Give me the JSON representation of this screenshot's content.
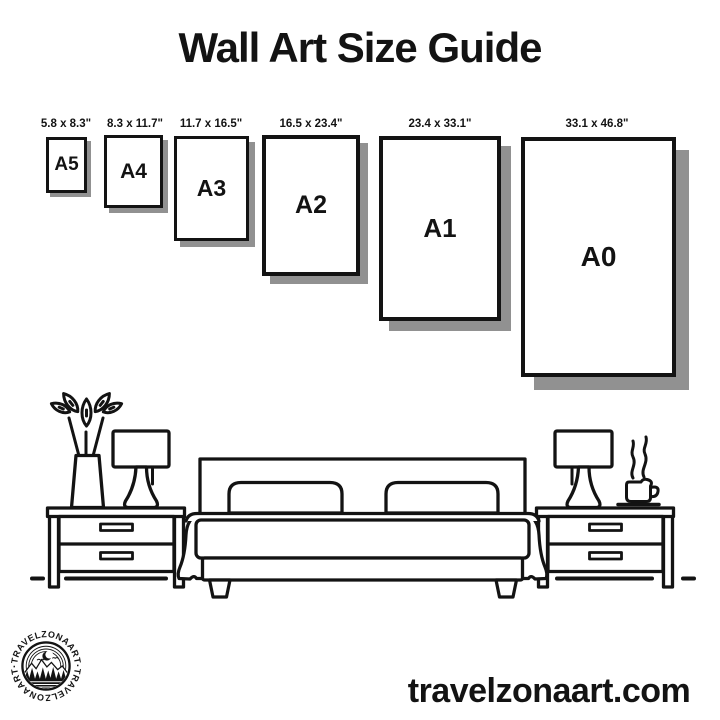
{
  "title": "Wall Art Size Guide",
  "frames": [
    {
      "label": "A5",
      "size": "5.8 x 8.3\""
    },
    {
      "label": "A4",
      "size": "8.3 x 11.7\""
    },
    {
      "label": "A3",
      "size": "11.7 x 16.5\""
    },
    {
      "label": "A2",
      "size": "16.5 x 23.4\""
    },
    {
      "label": "A1",
      "size": "23.4 x 33.1\""
    },
    {
      "label": "A0",
      "size": "33.1 x 46.8\""
    }
  ],
  "scene": {
    "items": [
      "potted-plant",
      "table-lamp",
      "nightstand",
      "double-bed",
      "pillows",
      "table-lamp",
      "coffee-cup",
      "nightstand"
    ]
  },
  "logo": {
    "brand": "TRAVELZONAART",
    "text_top": "·TRAVELZONAART·",
    "text_bottom": "·TRAVELZONAART·"
  },
  "footer": {
    "website": "travelzonaart.com"
  },
  "colors": {
    "ink": "#131313",
    "shadow": "#919191",
    "background": "#ffffff"
  }
}
